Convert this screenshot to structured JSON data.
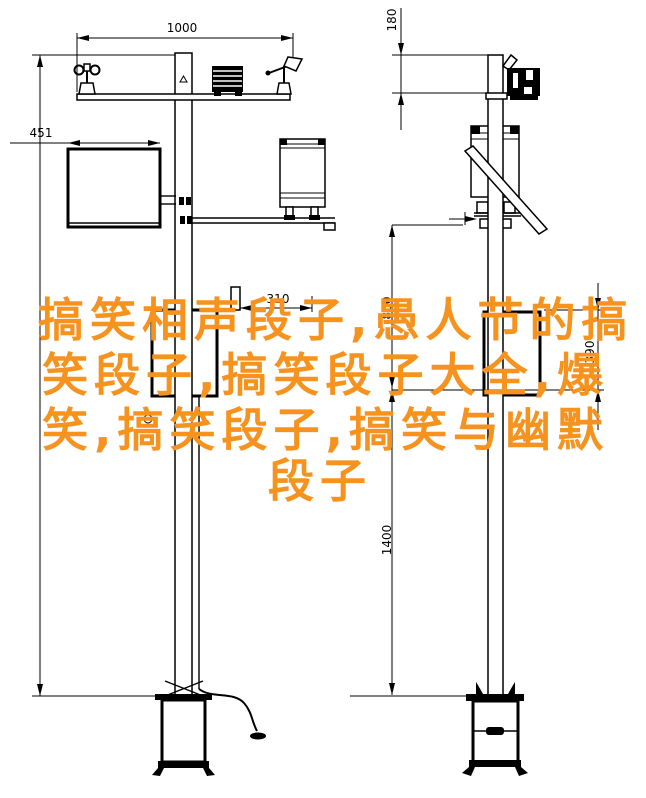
{
  "watermark": {
    "color": "#F6921E",
    "full_text": "搞笑相声段子,愚人节的搞笑段子,搞笑段子大全,爆笑,搞笑段子,搞笑与幽默段子",
    "lines": [
      "搞笑相声段子,愚人节的搞",
      "笑段子,搞笑段子大全,爆",
      "笑,搞笑段子,搞笑与幽默",
      "段子"
    ]
  },
  "drawing": {
    "type": "engineering-drawing",
    "subject": "weather-station pole, front and side elevation views",
    "line_color": "#000000",
    "background": "#FFFFFF",
    "dimensions": {
      "top_width": "1000",
      "left_height": "451",
      "pole_top_offset": "180",
      "box_offset": "310",
      "upper_span": "800",
      "box_height": "390",
      "lower_span": "1400"
    }
  }
}
